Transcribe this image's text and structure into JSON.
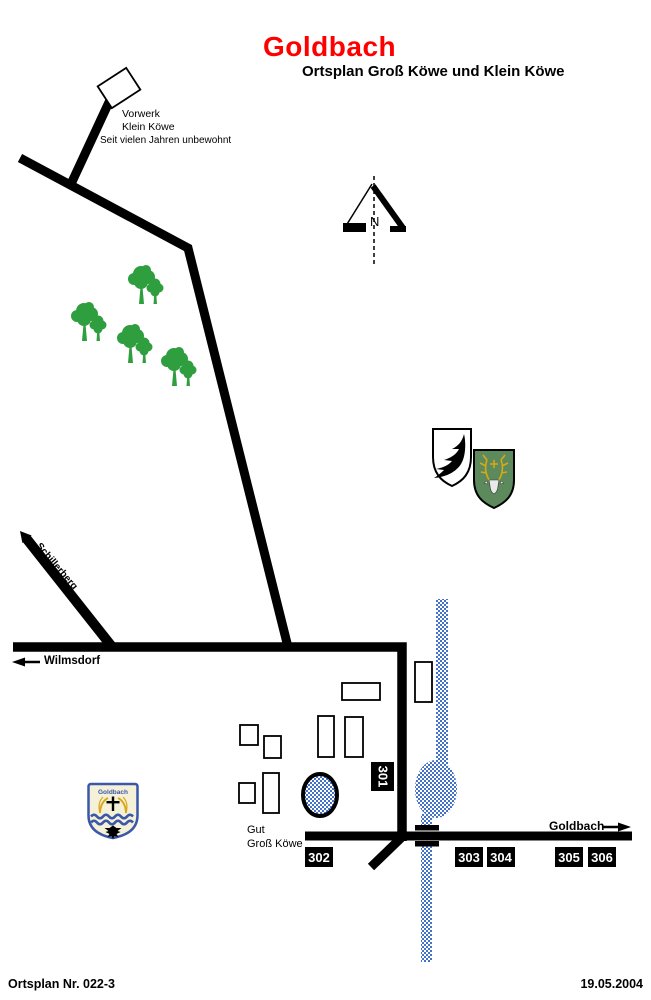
{
  "header": {
    "title": "Goldbach",
    "subtitle": "Ortsplan Groß Köwe und Klein Köwe"
  },
  "labels": {
    "vorwerk": [
      "Vorwerk",
      "Klein Köwe",
      "Seit vielen Jahren unbewohnt"
    ],
    "gut": [
      "Gut",
      "Groß Köwe"
    ]
  },
  "roads": {
    "schillerberg": "Schillerberg",
    "wilmsdorf": "Wilmsdorf",
    "goldbach": "Goldbach"
  },
  "compass": {
    "north": "N"
  },
  "plots": {
    "p301": "301",
    "p302": "302",
    "p303": "303",
    "p304": "304",
    "p305": "305",
    "p306": "306"
  },
  "coat_of_arms": {
    "village_name": "Goldbach"
  },
  "footer": {
    "left": "Ortsplan Nr. 022-3",
    "right": "19.05.2004"
  },
  "colors": {
    "title_red": "#ff0000",
    "road_black": "#000000",
    "tree_green": "#2f9e3e",
    "water_blue": "#4472c8",
    "shield_green": "#5c8a5c",
    "antler_gold": "#d8a818",
    "arms_blue": "#3a57a8",
    "arms_cream": "#f5f0d8"
  }
}
